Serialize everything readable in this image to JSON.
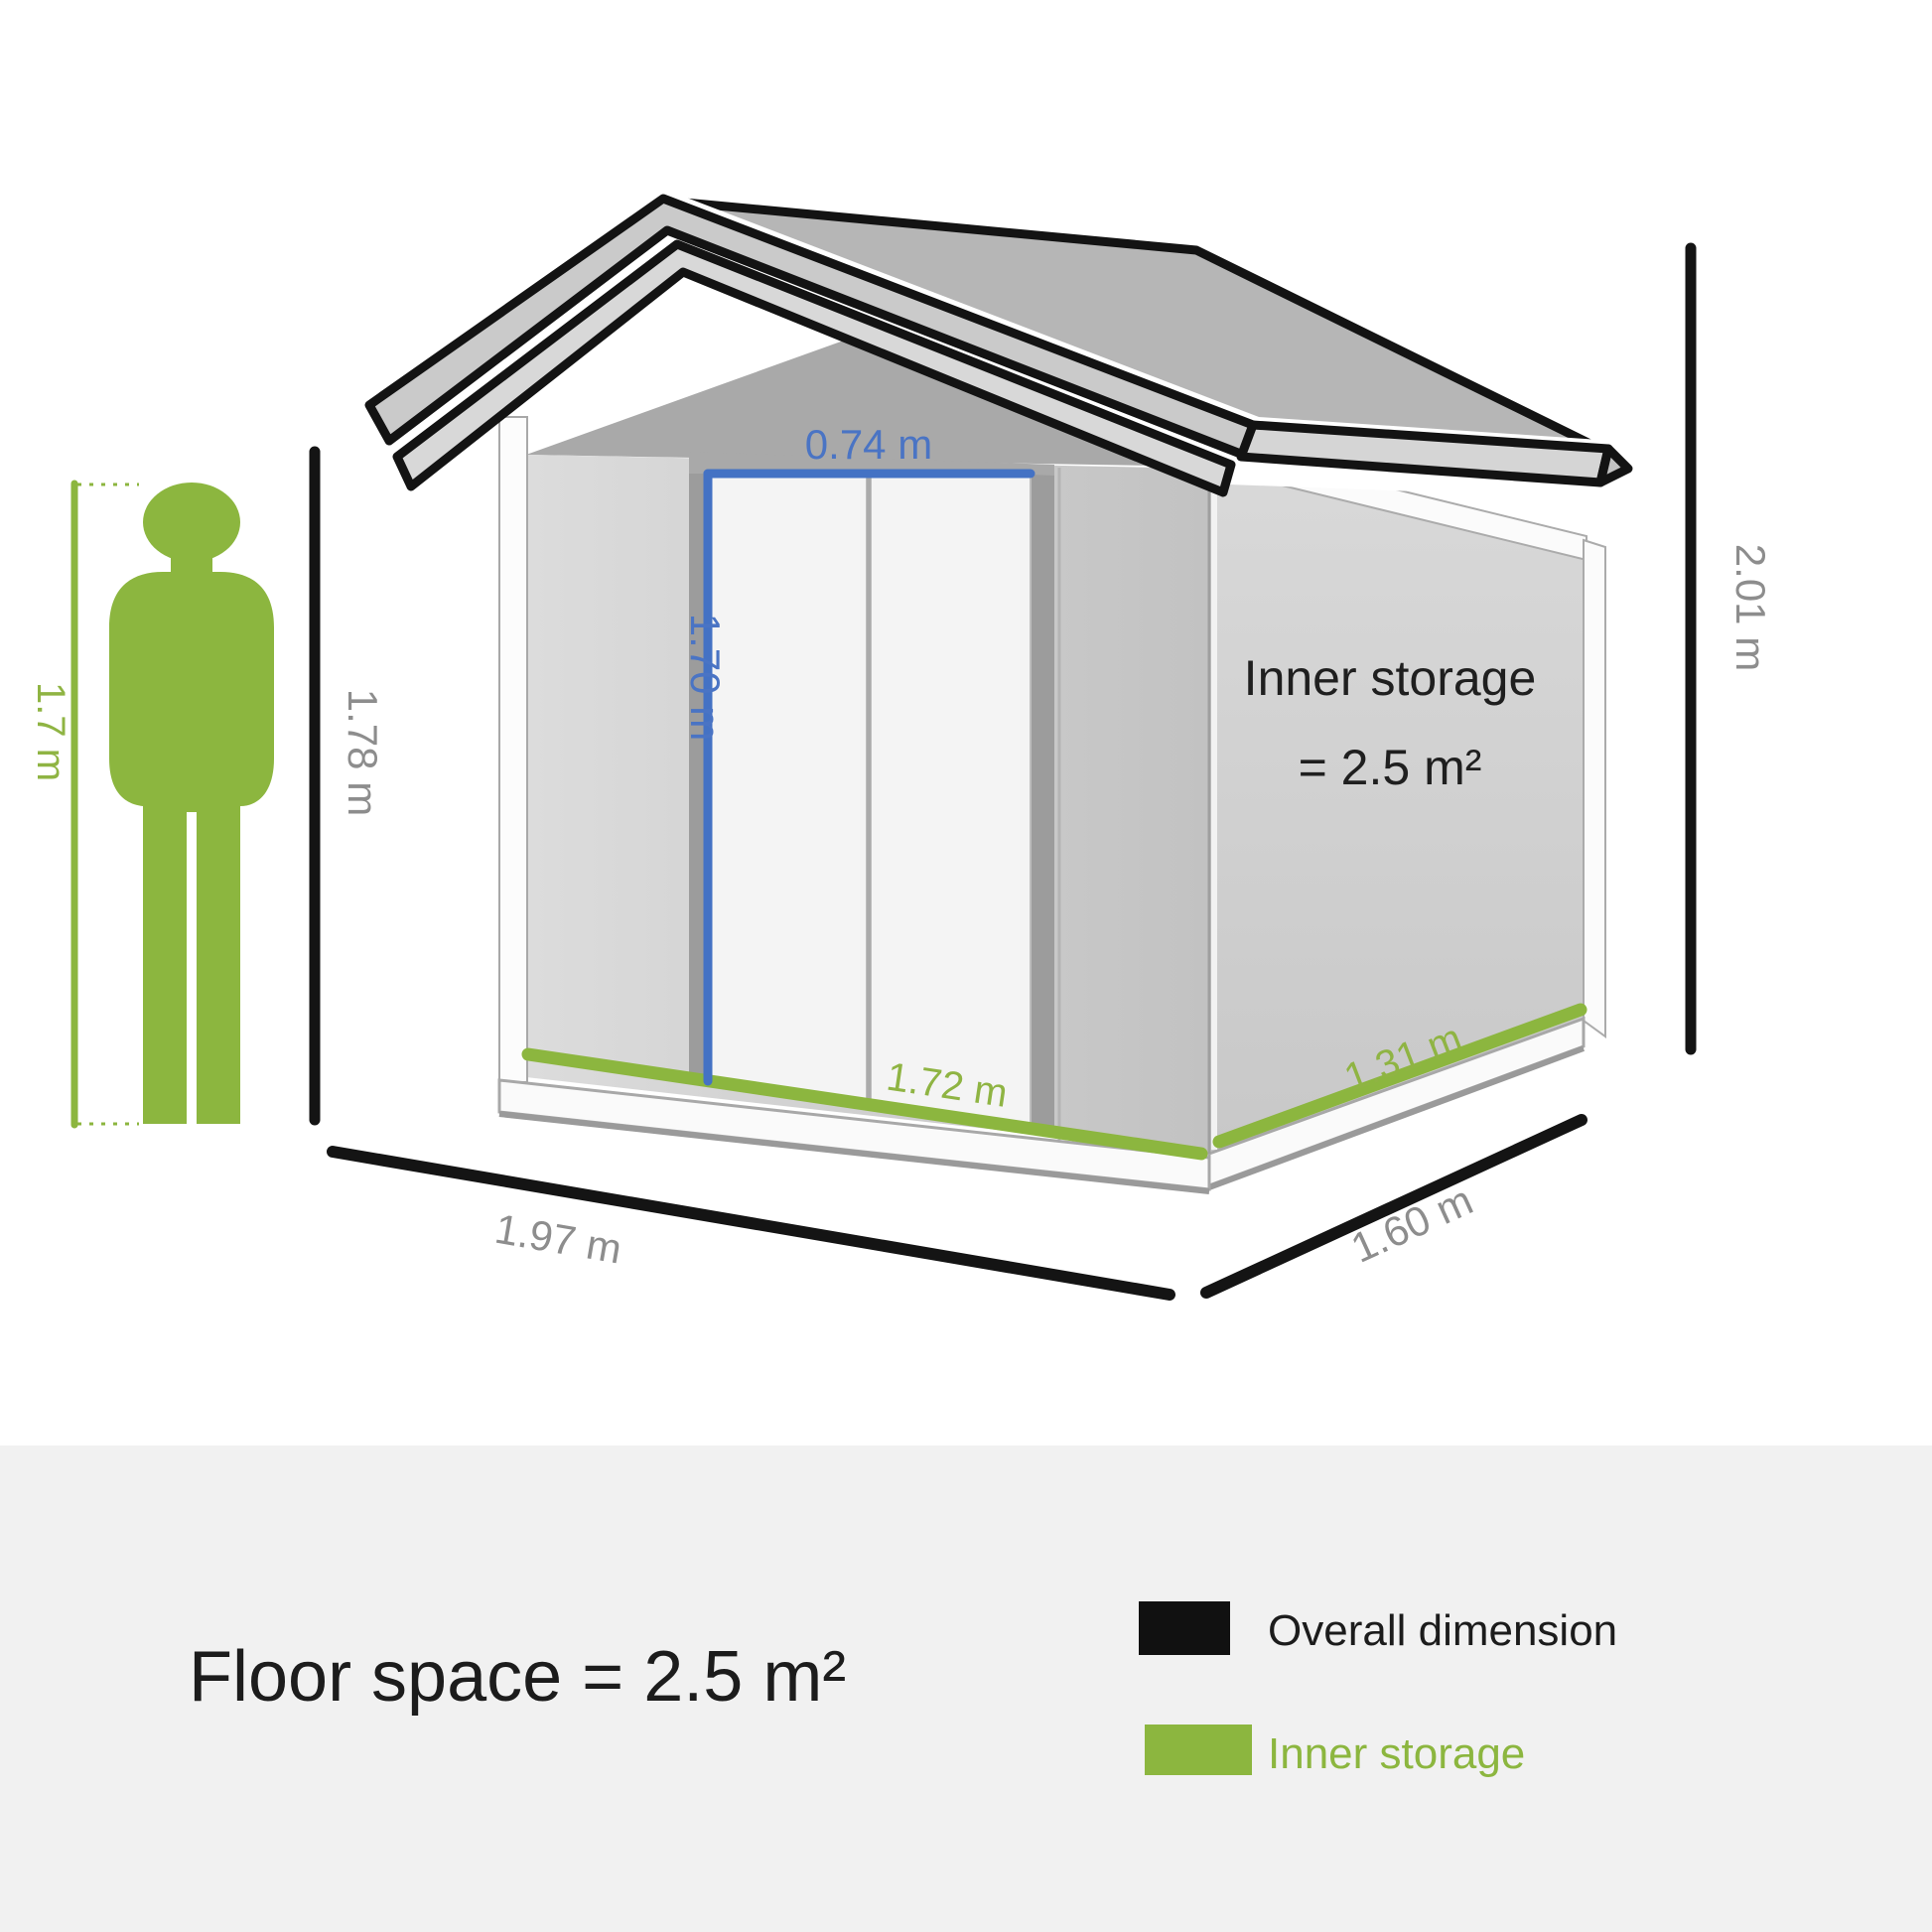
{
  "diagram": {
    "shed": {
      "inner_storage_line1": "Inner storage",
      "inner_storage_line2": "= 2.5 m²"
    },
    "dimensions": {
      "door_width": "0.74 m",
      "door_height": "1.70 m",
      "person_height": "1.7 m",
      "wall_height": "1.78 m",
      "overall_height": "2.01 m",
      "overall_width": "1.97 m",
      "overall_depth": "1.60 m",
      "inner_width": "1.72 m",
      "inner_depth": "1.31 m"
    },
    "colors": {
      "overall_dimension_black": "#141414",
      "inner_storage_green": "#8cb63f",
      "door_dimension_blue": "#4472c4",
      "label_gray": "#8d8d8d"
    }
  },
  "footer": {
    "floor_space": "Floor space = 2.5 m²",
    "legend": [
      {
        "label": "Overall dimension",
        "swatch": "#111111"
      },
      {
        "label": "Inner storage",
        "swatch": "#8cb63f"
      }
    ]
  }
}
